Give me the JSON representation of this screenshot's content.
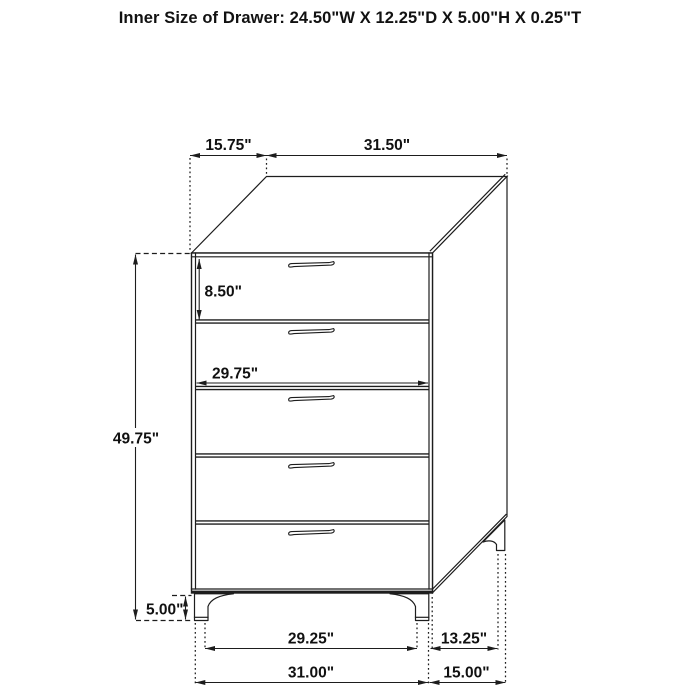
{
  "title": "Inner Size of Drawer: 24.50\"W X 12.25\"D X 5.00\"H X 0.25\"T",
  "chest": {
    "drawer_count": 5
  },
  "dimensions": {
    "top_depth": "15.75\"",
    "top_width": "31.50\"",
    "top_drawer_height": "8.50\"",
    "drawer_front_width": "29.75\"",
    "body_height": "49.75\"",
    "leg_height": "5.00\"",
    "front_feet_inner_span": "29.25\"",
    "side_feet_gap": "13.25\"",
    "front_feet_outer_span": "31.00\"",
    "side_depth_bottom": "15.00\""
  }
}
